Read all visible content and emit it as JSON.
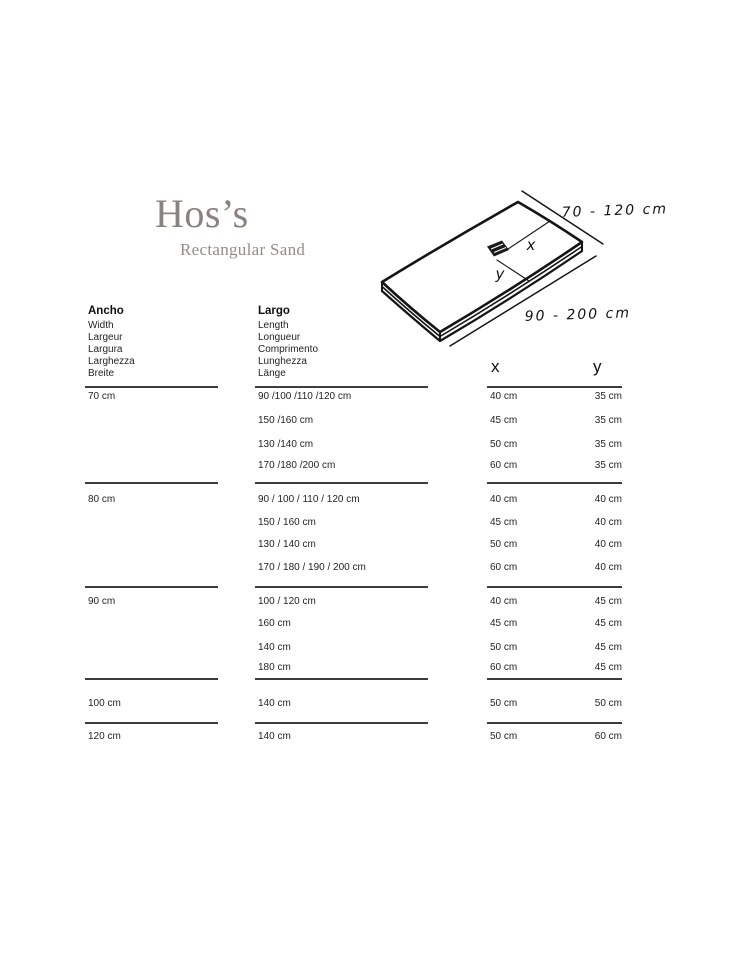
{
  "brand": {
    "title": "Hos’s",
    "subtitle": "Rectangular Sand"
  },
  "diagram": {
    "width_range_label": "70 - 120 cm",
    "length_range_label": "90 - 200 cm",
    "x_axis_label": "x",
    "y_axis_label": "y"
  },
  "columns": {
    "width": {
      "title": "Ancho",
      "translations": [
        "Width",
        "Largeur",
        "Largura",
        "Larghezza",
        "Breite"
      ]
    },
    "length": {
      "title": "Largo",
      "translations": [
        "Length",
        "Longueur",
        "Comprimento",
        "Lunghezza",
        "Länge"
      ]
    },
    "drain": {
      "x": "x",
      "y": "y"
    }
  },
  "size_blocks": [
    {
      "width": "70 cm",
      "lengths": [
        "90 /100 /110 /120 cm",
        "150 /160 cm",
        "130 /140 cm",
        "170 /180 /200 cm"
      ],
      "drain_positions": [
        {
          "x": "40 cm",
          "y": "35 cm"
        },
        {
          "x": "45 cm",
          "y": "35 cm"
        },
        {
          "x": "50 cm",
          "y": "35 cm"
        },
        {
          "x": "60 cm",
          "y": "35 cm"
        }
      ]
    },
    {
      "width": "80 cm",
      "lengths": [
        "90 / 100 / 110 / 120 cm",
        "150 / 160 cm",
        "130 / 140 cm",
        "170 / 180 / 190 / 200 cm"
      ],
      "drain_positions": [
        {
          "x": "40 cm",
          "y": "40 cm"
        },
        {
          "x": "45 cm",
          "y": "40 cm"
        },
        {
          "x": "50 cm",
          "y": "40 cm"
        },
        {
          "x": "60 cm",
          "y": "40 cm"
        }
      ]
    },
    {
      "width": "90 cm",
      "lengths": [
        "100 / 120 cm",
        "160 cm",
        "140 cm",
        "180 cm"
      ],
      "drain_positions": [
        {
          "x": "40 cm",
          "y": "45 cm"
        },
        {
          "x": "45 cm",
          "y": "45 cm"
        },
        {
          "x": "50 cm",
          "y": "45 cm"
        },
        {
          "x": "60 cm",
          "y": "45 cm"
        }
      ]
    },
    {
      "width": "100 cm",
      "lengths": [
        "140 cm"
      ],
      "drain_positions": [
        {
          "x": "50 cm",
          "y": "50 cm"
        }
      ]
    },
    {
      "width": "120 cm",
      "lengths": [
        "140 cm"
      ],
      "drain_positions": [
        {
          "x": "50 cm",
          "y": "60 cm"
        }
      ]
    }
  ]
}
